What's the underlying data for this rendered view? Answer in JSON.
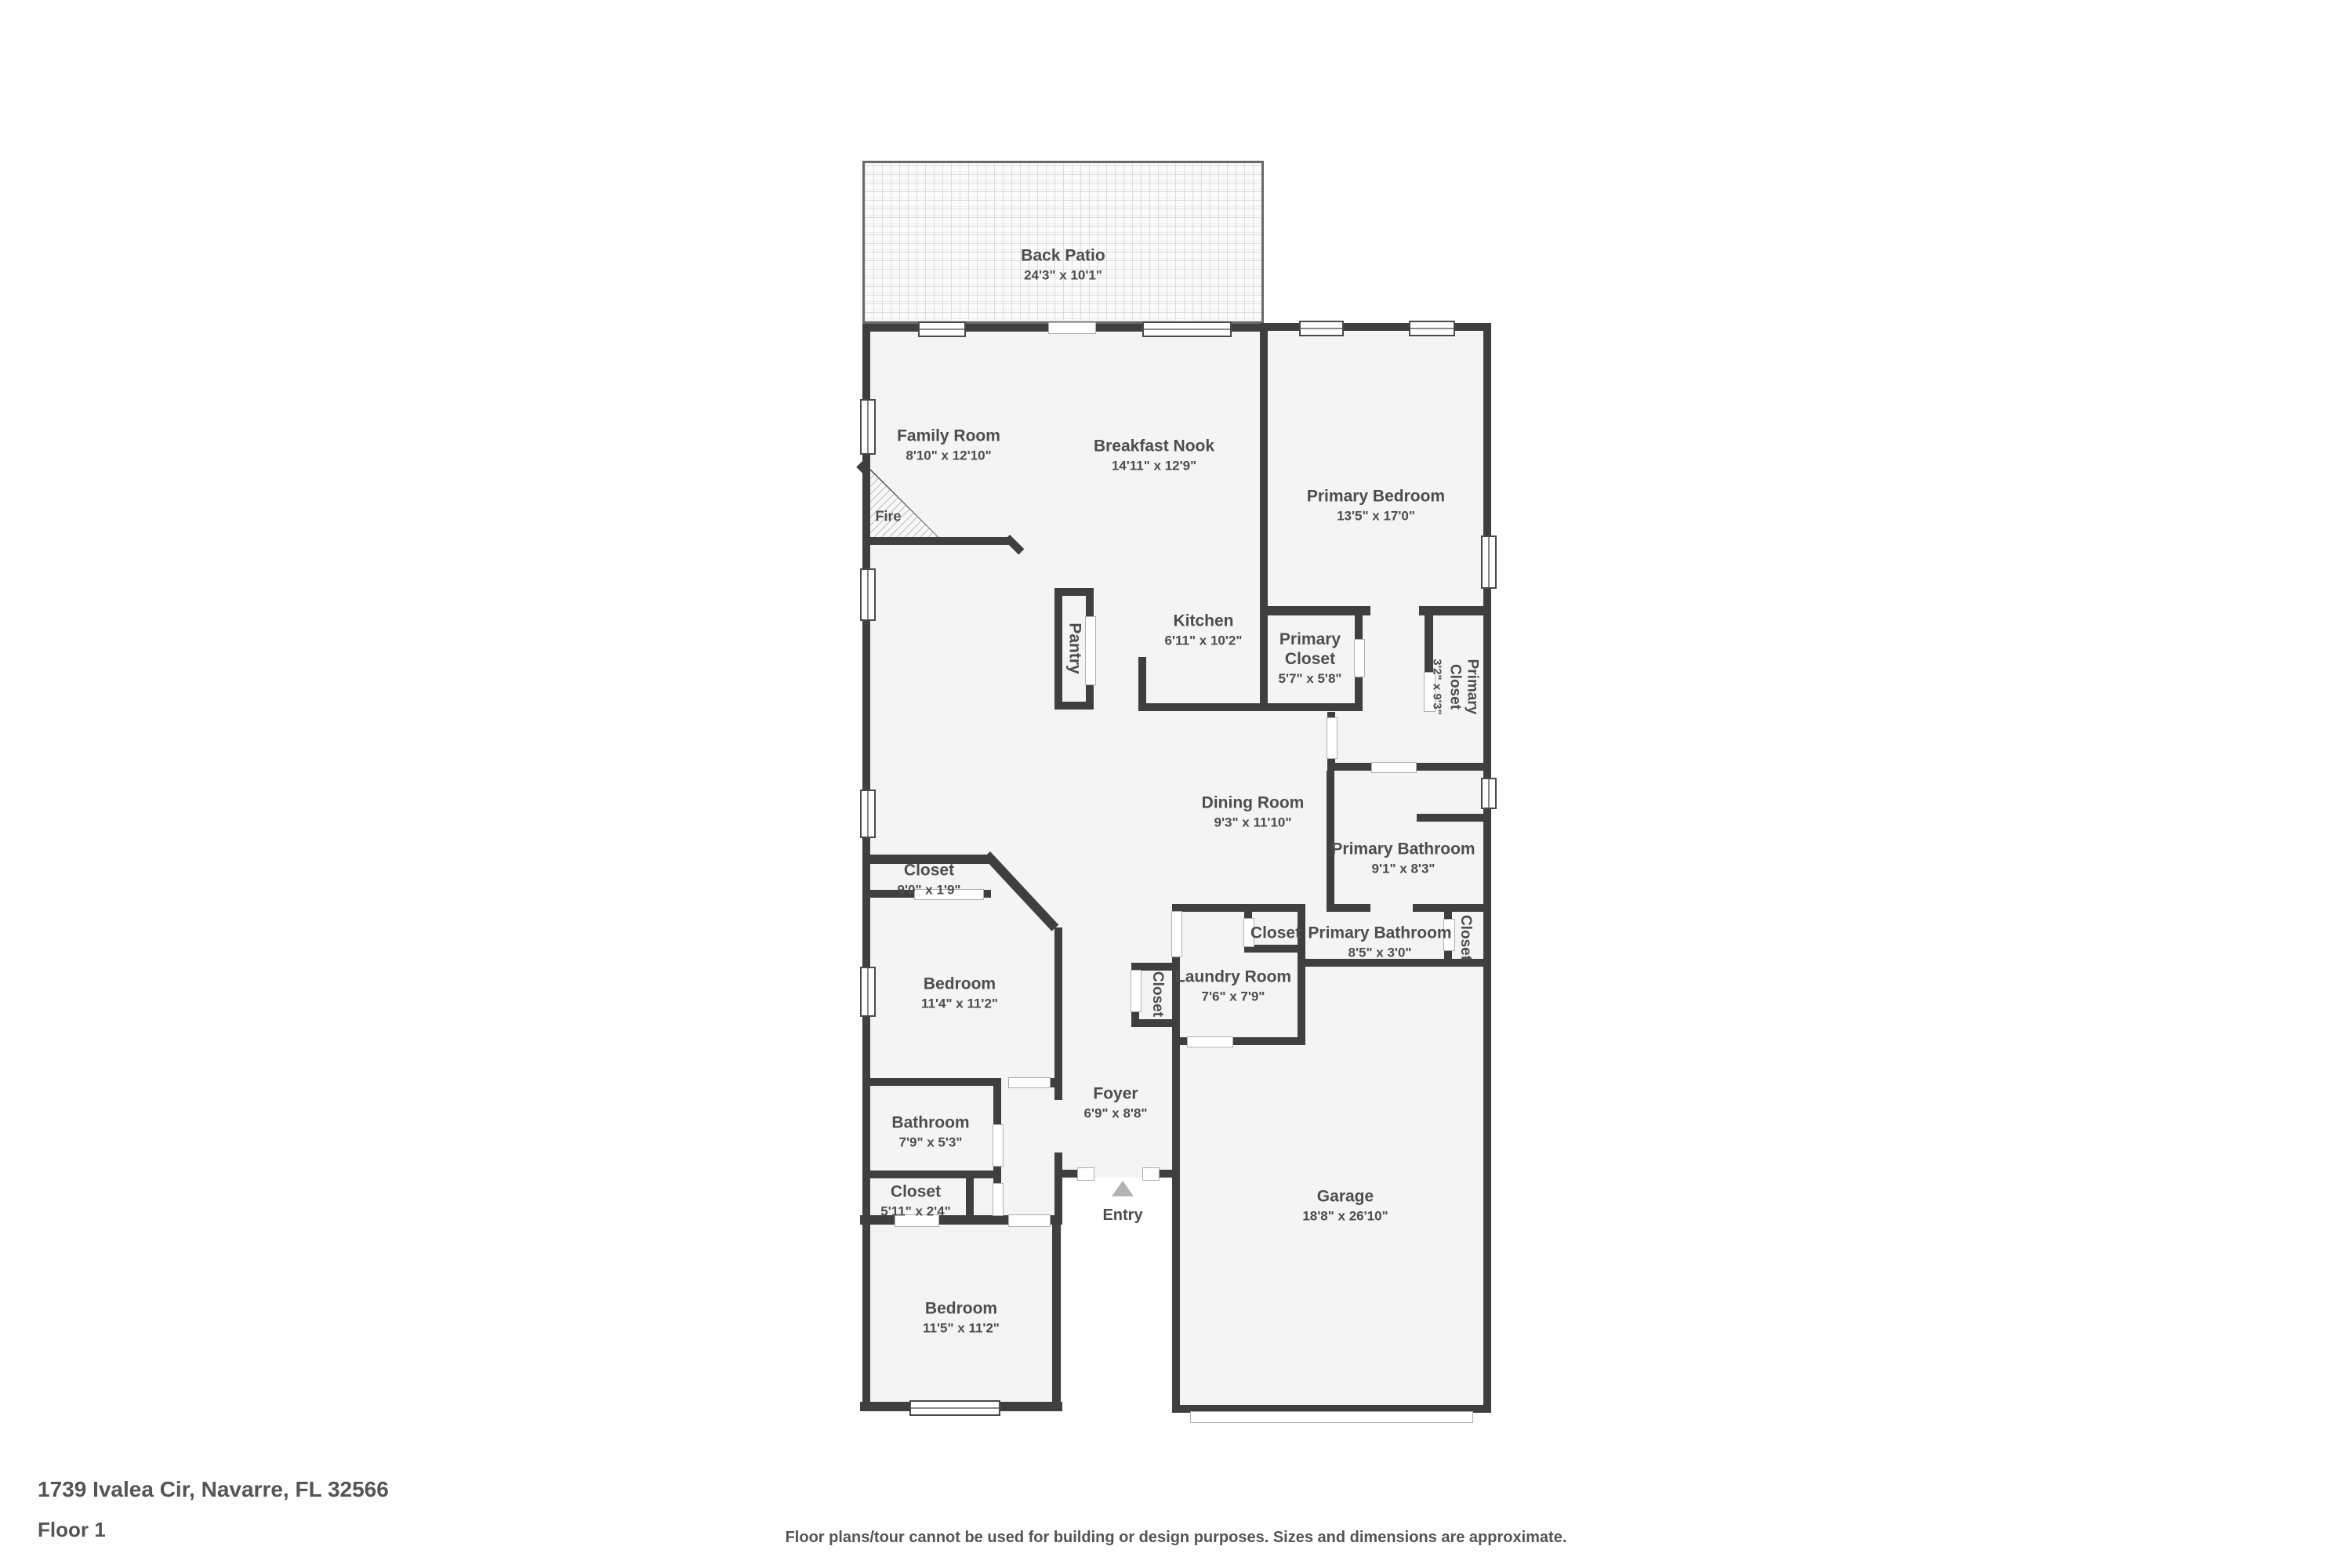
{
  "rooms": [
    {
      "name": "Back Patio",
      "dims": "24'3\" x 10'1\""
    },
    {
      "name": "Family Room",
      "dims": "8'10\" x 12'10\""
    },
    {
      "name": "Breakfast Nook",
      "dims": "14'11\" x 12'9\""
    },
    {
      "name": "Primary Bedroom",
      "dims": "13'5\" x 17'0\""
    },
    {
      "name": "Fire"
    },
    {
      "name": "Kitchen",
      "dims": "6'11\" x 10'2\""
    },
    {
      "name": "Pantry"
    },
    {
      "name": "Primary\nCloset",
      "dims": "5'7\" x 5'8\""
    },
    {
      "name": "Primary\nCloset",
      "dims": "3'2\" x 9'3\""
    },
    {
      "name": "Dining Room",
      "dims": "9'3\" x 11'10\""
    },
    {
      "name": "Primary Bathroom",
      "dims": "9'1\" x 8'3\""
    },
    {
      "name": "Closet",
      "dims": "9'0\" x 1'9\""
    },
    {
      "name": "Bedroom",
      "dims": "11'4\" x 11'2\""
    },
    {
      "name": "Closet"
    },
    {
      "name": "Primary Bathroom",
      "dims": "8'5\" x 3'0\""
    },
    {
      "name": "Closet"
    },
    {
      "name": "Laundry Room",
      "dims": "7'6\" x 7'9\""
    },
    {
      "name": "Closet"
    },
    {
      "name": "Foyer",
      "dims": "6'9\" x 8'8\""
    },
    {
      "name": "Bathroom",
      "dims": "7'9\" x 5'3\""
    },
    {
      "name": "Closet",
      "dims": "5'11\" x 2'4\""
    },
    {
      "name": "Garage",
      "dims": "18'8\" x 26'10\""
    },
    {
      "name": "Entry"
    },
    {
      "name": "Bedroom",
      "dims": "11'5\" x 11'2\""
    }
  ],
  "footer": {
    "address": "1739 Ivalea Cir, Navarre, FL 32566",
    "floor_label": "Floor 1",
    "disclaimer": "Floor plans/tour cannot be used for building or design purposes. Sizes and dimensions are approximate."
  },
  "colors": {
    "wall": "#3f3f3f",
    "room_fill": "#f4f4f4",
    "label_text": "#4d4d4d",
    "entry_arrow": "#b3b3b3"
  }
}
